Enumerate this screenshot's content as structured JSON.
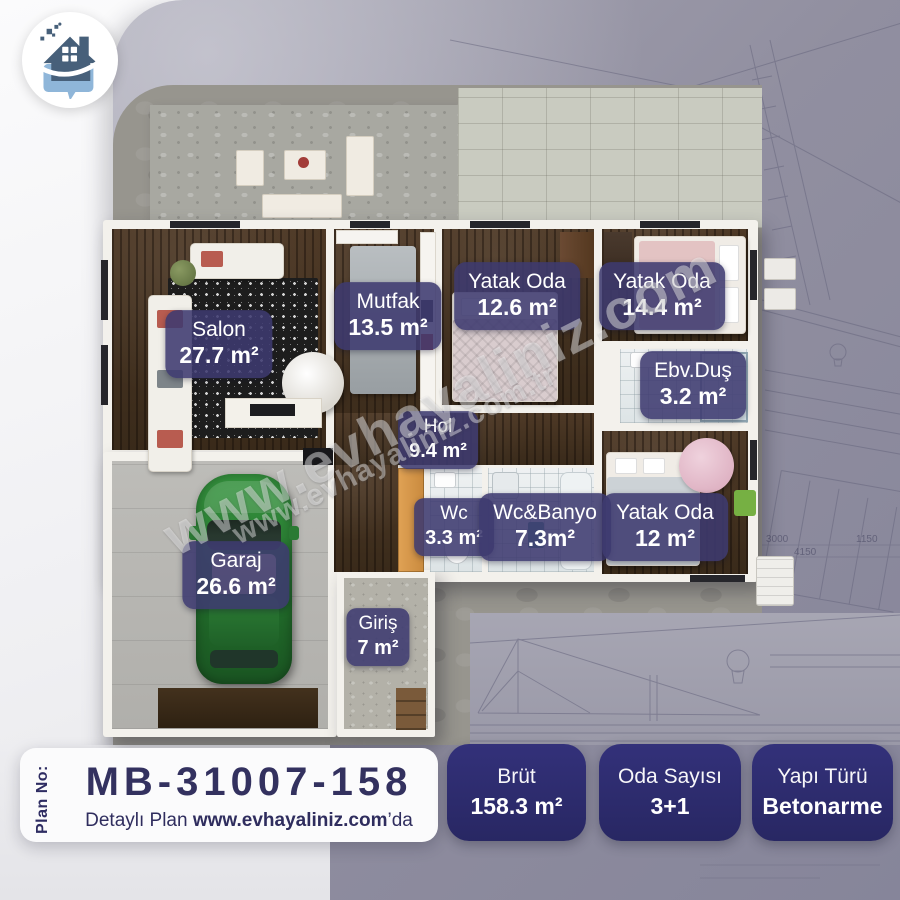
{
  "logo": {
    "icon": "house-chat-icon"
  },
  "watermark": {
    "line1": "www.evhayaliniz.com",
    "line2": "www.evhayaliniz.com.tr"
  },
  "rooms": [
    {
      "name": "Salon",
      "area": "27.7 m²"
    },
    {
      "name": "Mutfak",
      "area": "13.5 m²"
    },
    {
      "name": "Yatak Oda",
      "area": "12.6 m²"
    },
    {
      "name": "Yatak Oda",
      "area": "14.4 m²"
    },
    {
      "name": "Ebv.Duş",
      "area": "3.2 m²"
    },
    {
      "name": "Hol",
      "area": "9.4 m²"
    },
    {
      "name": "Wc",
      "area": "3.3 m²"
    },
    {
      "name": "Wc&Banyo",
      "area": "7.3m²"
    },
    {
      "name": "Yatak Oda",
      "area": "12 m²"
    },
    {
      "name": "Garaj",
      "area": "26.6 m²"
    },
    {
      "name": "Giriş",
      "area": "7 m²"
    }
  ],
  "info_panel": {
    "plan_no_label": "Plan No:",
    "plan_no": "MB-31007-158",
    "detail_prefix": "Detaylı Plan ",
    "detail_site": "www.evhayaliniz.com",
    "detail_suffix": "’da"
  },
  "stats": [
    {
      "label": "Brüt",
      "value": "158.3 m²"
    },
    {
      "label": "Oda Sayısı",
      "value": "3+1"
    },
    {
      "label": "Yapı Türü",
      "value": "Betonarme"
    }
  ],
  "blueprint": {
    "dims": [
      "3000",
      "4150",
      "1150"
    ]
  },
  "colors": {
    "stat_badge": "#2b2a6e",
    "room_badge": "#3e3a70",
    "navy_text": "#33315f",
    "logo_house": "#47607a",
    "logo_bubble": "#8fb6d9",
    "car_green": "#2e8b3d",
    "background_gray": "#8f8e9d"
  }
}
